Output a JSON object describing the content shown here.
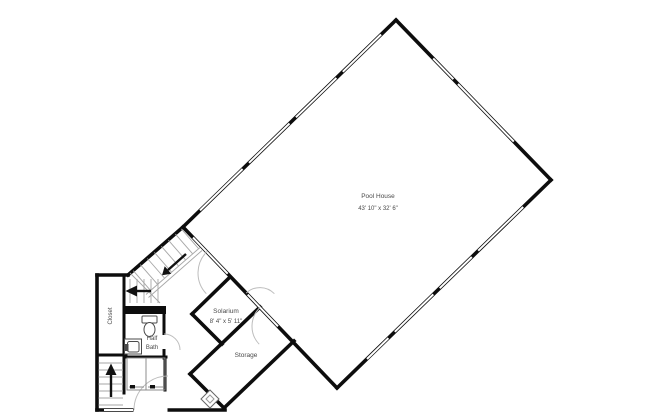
{
  "plan_title": "Pool house floor plan",
  "rooms": {
    "pool_house": {
      "label": "Pool House",
      "dimensions": "43' 10\" x 32' 6\""
    },
    "solarium": {
      "label": "Solarium",
      "dimensions": "8' 4\" x 5' 11\""
    },
    "storage": {
      "label": "Storage"
    },
    "half_bath": {
      "label_line1": "Half",
      "label_line2": "Bath"
    },
    "closet": {
      "label": "Closet"
    }
  },
  "colors": {
    "background": "#ffffff",
    "wall": "#0d0d0d",
    "window_edge": "#0d0d0d",
    "door_arc": "#bdbdbd",
    "stair_tread": "#a6a6a6",
    "fixture_outline": "#4a4a4a",
    "label_text": "#4a4a4a"
  }
}
